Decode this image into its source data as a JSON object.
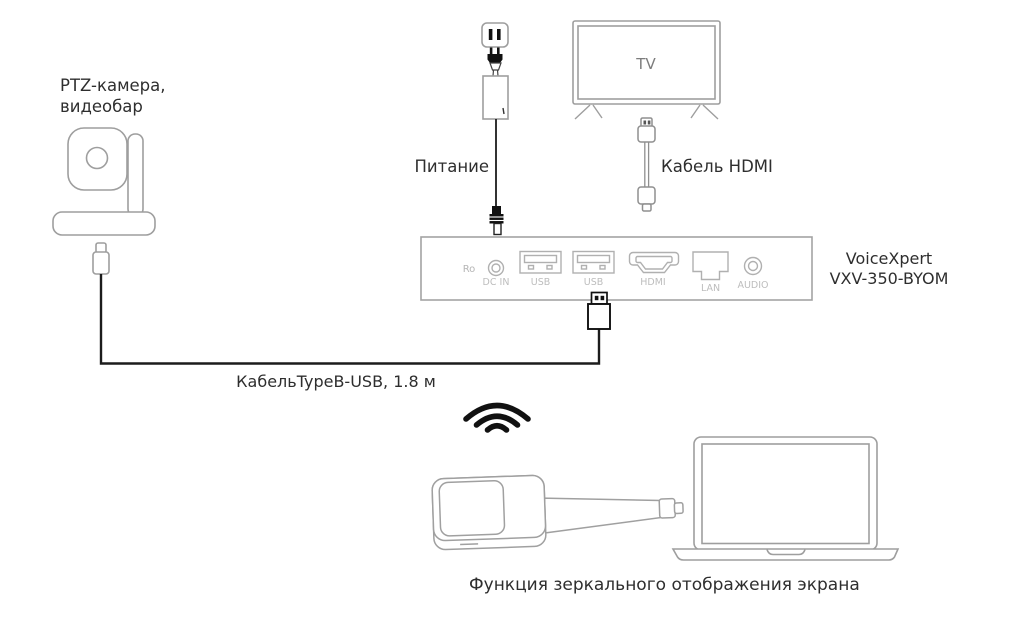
{
  "diagram": {
    "camera_label_line1": "PTZ-камера,",
    "camera_label_line2": "видеобар",
    "power_label": "Питание",
    "tv_label": "TV",
    "hdmi_cable_label": "Кабель HDMI",
    "device_model_line1": "VoiceXpert",
    "device_model_line2": "VXV-350-BYOM",
    "usb_cable_label": "КабельTypeB-USB, 1.8 м",
    "caption": "Функция зеркального отображения экрана"
  },
  "device_panel": {
    "ro_label": "Ro",
    "ports": [
      {
        "name": "dc-in-port",
        "label": "DC IN"
      },
      {
        "name": "usb-port-1",
        "label": "USB"
      },
      {
        "name": "usb-port-2",
        "label": "USB"
      },
      {
        "name": "hdmi-port",
        "label": "HDMI"
      },
      {
        "name": "lan-port",
        "label": "LAN"
      },
      {
        "name": "audio-port",
        "label": "AUDIO"
      }
    ]
  },
  "icons": {
    "wifi": "wifi-icon",
    "camera": "ptz-camera-illustration",
    "power_outlet": "power-outlet-illustration",
    "power_adapter": "power-adapter-illustration",
    "tv": "tv-illustration",
    "hdmi_cable": "hdmi-cable-illustration",
    "usb_plug": "usb-plug-illustration",
    "dongle": "wireless-dongle-illustration",
    "laptop": "laptop-illustration"
  },
  "colors": {
    "line_gray": "#a0a0a0",
    "port_line_gray": "#b0b0b0",
    "port_label_gray": "#bdbdbd",
    "black": "#1a1a1a",
    "text_dark": "#2e2e2e",
    "background": "#ffffff"
  }
}
